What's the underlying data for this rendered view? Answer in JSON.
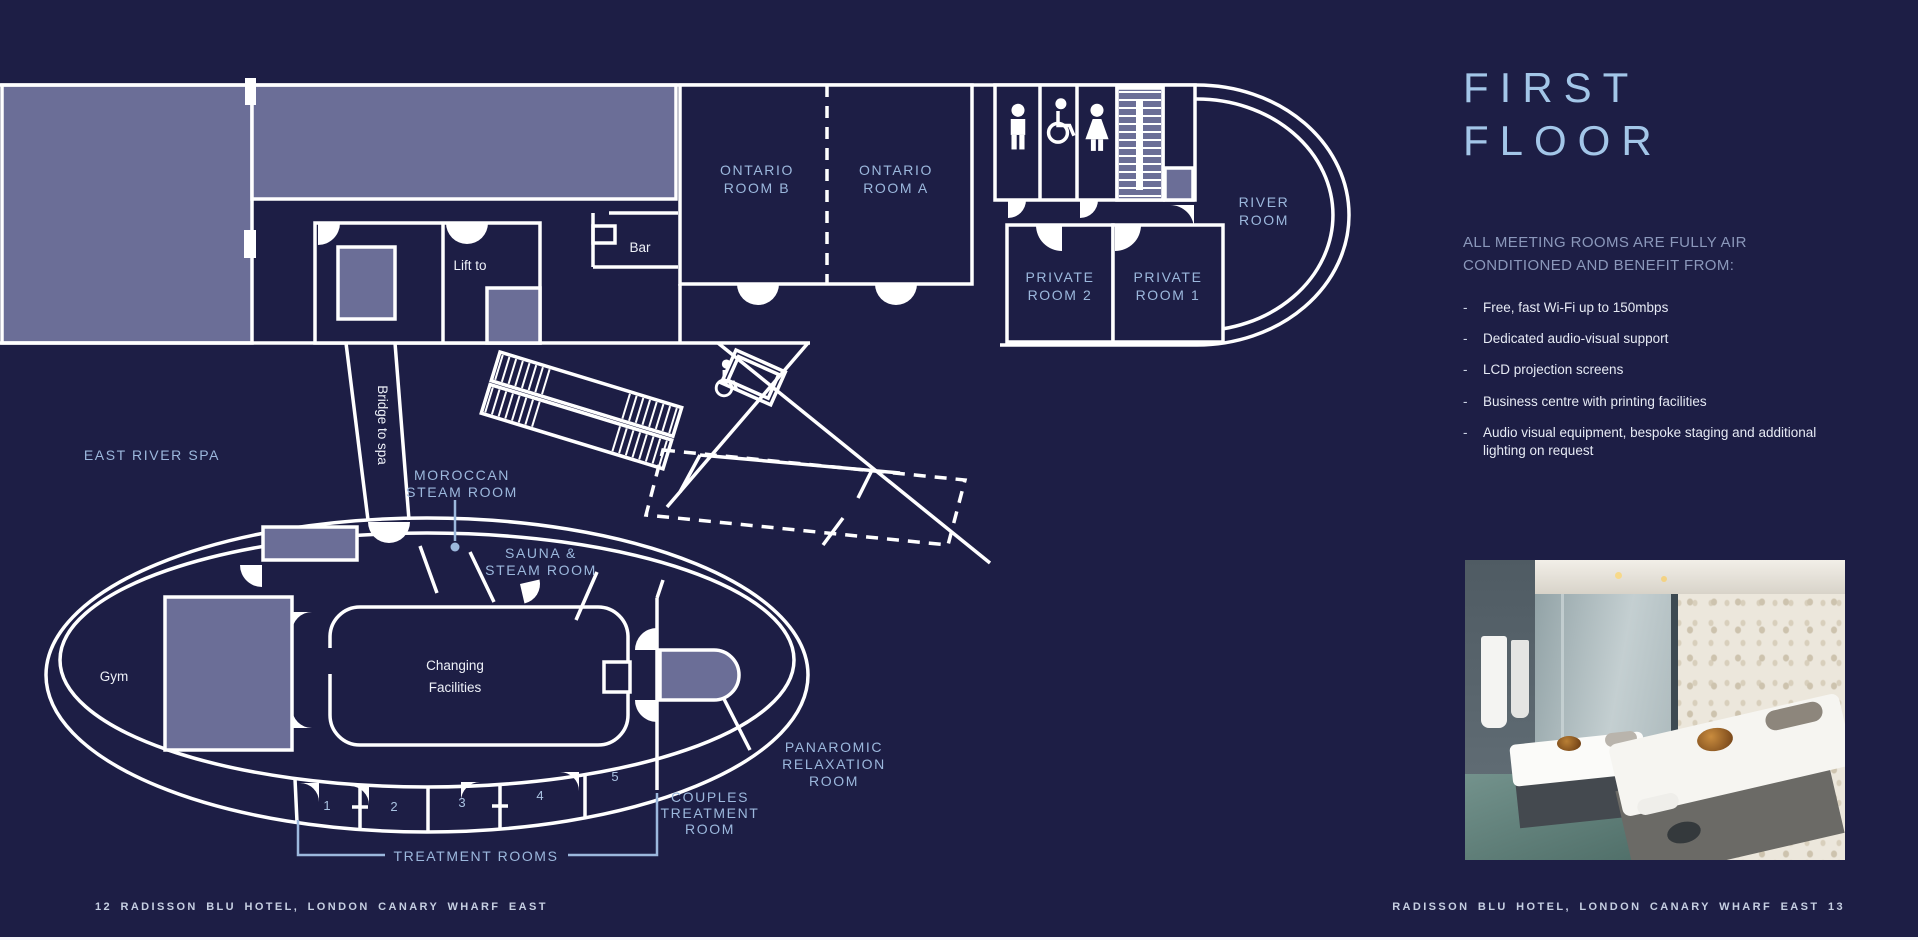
{
  "title": {
    "line1": "FIRST",
    "line2": "FLOOR"
  },
  "info": {
    "heading": "ALL MEETING ROOMS ARE FULLY AIR CONDITIONED AND BENEFIT FROM:",
    "bullet_char": "-",
    "bullets": [
      "Free, fast Wi-Fi up to 150mbps",
      "Dedicated audio-visual support",
      "LCD projection screens",
      "Business centre with printing facilities",
      "Audio visual equipment, bespoke staging and additional lighting on request"
    ]
  },
  "plan": {
    "labels": {
      "ontario_b": [
        "ONTARIO",
        "ROOM B"
      ],
      "ontario_a": [
        "ONTARIO",
        "ROOM A"
      ],
      "river_room": [
        "RIVER",
        "ROOM"
      ],
      "private_room_2": [
        "PRIVATE",
        "ROOM 2"
      ],
      "private_room_1": [
        "PRIVATE",
        "ROOM 1"
      ],
      "bar": "Bar",
      "lift_to": "Lift to",
      "bridge_to_spa": "Bridge to spa",
      "east_river_spa": "EAST RIVER SPA",
      "moroccan": [
        "MOROCCAN",
        "STEAM ROOM"
      ],
      "sauna": [
        "SAUNA &",
        "STEAM ROOM"
      ],
      "changing": [
        "Changing",
        "Facilities"
      ],
      "gym": "Gym",
      "panaromic": [
        "PANAROMIC",
        "RELAXATION",
        "ROOM"
      ],
      "couples": [
        "COUPLES",
        "TREATMENT",
        "ROOM"
      ],
      "treatment_rooms": "TREATMENT ROOMS",
      "treatment_numbers": [
        "1",
        "2",
        "3",
        "4",
        "5"
      ]
    },
    "icons": [
      "male-restroom-icon",
      "accessible-restroom-icon",
      "female-restroom-icon",
      "accessible-icon"
    ]
  },
  "footer": {
    "left": "12 RADISSON BLU HOTEL, LONDON CANARY WHARF EAST",
    "right": "RADISSON BLU HOTEL, LONDON CANARY WHARF EAST 13"
  },
  "colors": {
    "background": "#1d1e45",
    "panel_light": "#6b6e97",
    "line": "#ffffff",
    "title_blue": "#a3c6e8",
    "label_blue": "#9cb8dd",
    "body_text": "#e6eaf4",
    "heading_text": "#8b98bb",
    "footer_text": "#c6cfe2"
  }
}
